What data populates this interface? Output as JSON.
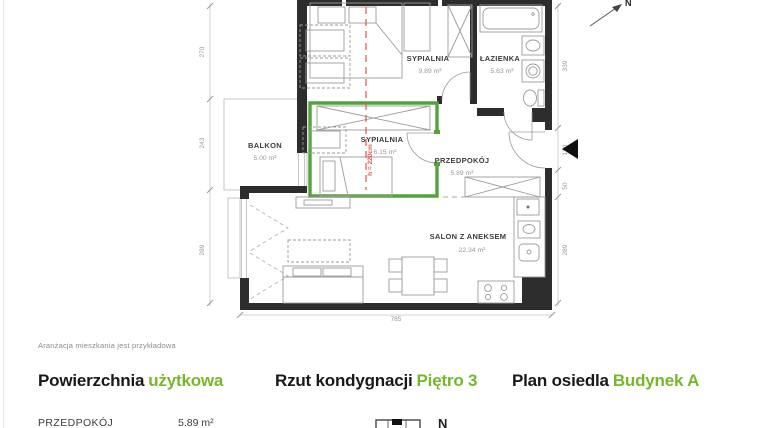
{
  "colors": {
    "accent_green": "#76b82a",
    "plan_green": "#52a33c",
    "dash_red": "#e2544e",
    "wall_black": "#2d2d2d"
  },
  "floorplan": {
    "north": "N",
    "height_label": "h = 220cm",
    "rooms": {
      "bedroom1": {
        "name": "SYPIALNIA",
        "area": "9.89 m²"
      },
      "bathroom": {
        "name": "ŁAZIENKA",
        "area": "5.63 m²"
      },
      "bedroom2": {
        "name": "SYPIALNIA",
        "area": "6.15 m²"
      },
      "hall": {
        "name": "PRZEDPOKÓJ",
        "area": "5.89 m²"
      },
      "balcony": {
        "name": "BALKON",
        "area": "5.00 m²"
      },
      "living": {
        "name": "SALON Z ANEKSEM",
        "area": "22.34 m²"
      }
    },
    "dims": {
      "left_270": "270",
      "left_243": "243",
      "left_289": "289",
      "right_339": "339",
      "right_130": "130",
      "right_50": "50",
      "right_289": "289",
      "bottom_785": "785"
    }
  },
  "note": "Aranżacja mieszkania jest przykładowa",
  "headings": {
    "h1_black": "Powierzchnia",
    "h1_green": "użytkowa",
    "h2_black": "Rzut kondygnacji",
    "h2_green": "Piętro 3",
    "h3_black": "Plan osiedla",
    "h3_green": "Budynek A"
  },
  "bottom_row": {
    "room": "PRZEDPOKÓJ",
    "area": "5.89 m²",
    "north": "N"
  }
}
